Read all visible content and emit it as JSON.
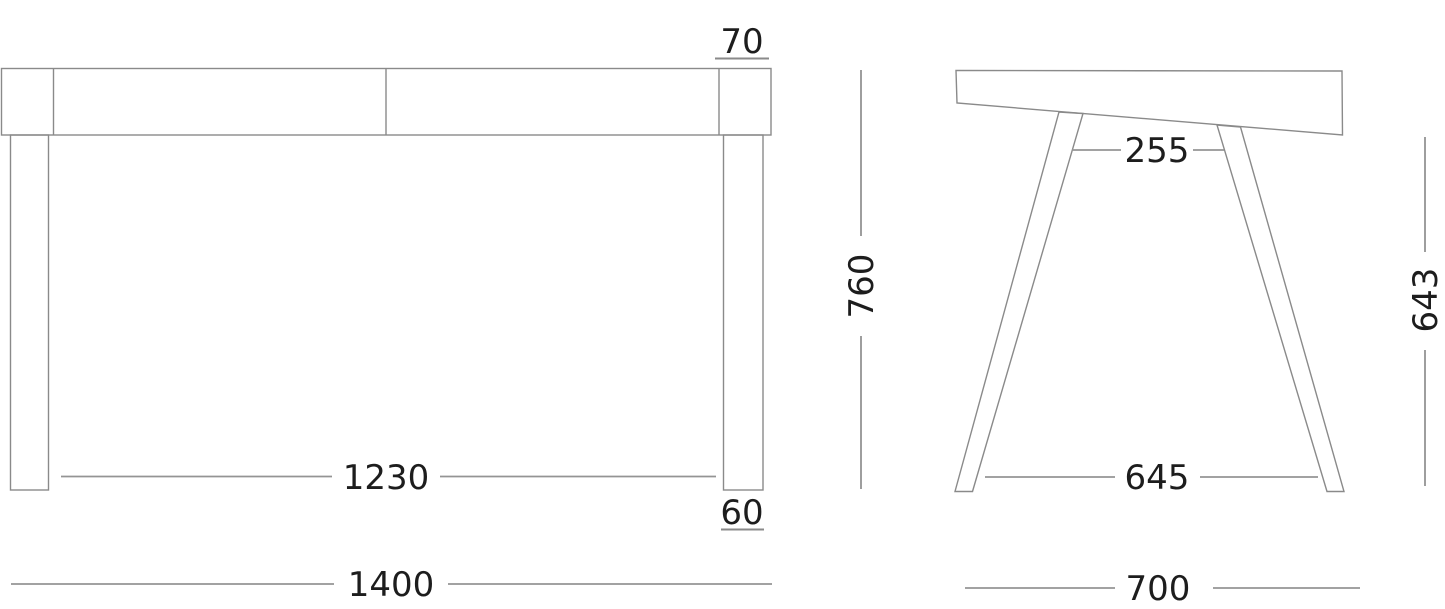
{
  "drawing": {
    "type": "furniture-technical-drawing",
    "subject": "desk / console table, two orthographic views",
    "front_view": {
      "name": "front-elevation",
      "dims": {
        "top_thickness": "70",
        "overall_height": "760",
        "inner_leg_span": "1230",
        "leg_width": "60",
        "overall_width": "1400"
      }
    },
    "side_view": {
      "name": "side-elevation",
      "dims": {
        "top_leg_gap": "255",
        "underside_height": "643",
        "bottom_leg_span": "645",
        "overall_depth": "700"
      }
    },
    "colors": {
      "background": "#ffffff",
      "shape_line": "#8a8a8a",
      "dimension_line": "#949494",
      "text": "#1d1d1d"
    }
  }
}
